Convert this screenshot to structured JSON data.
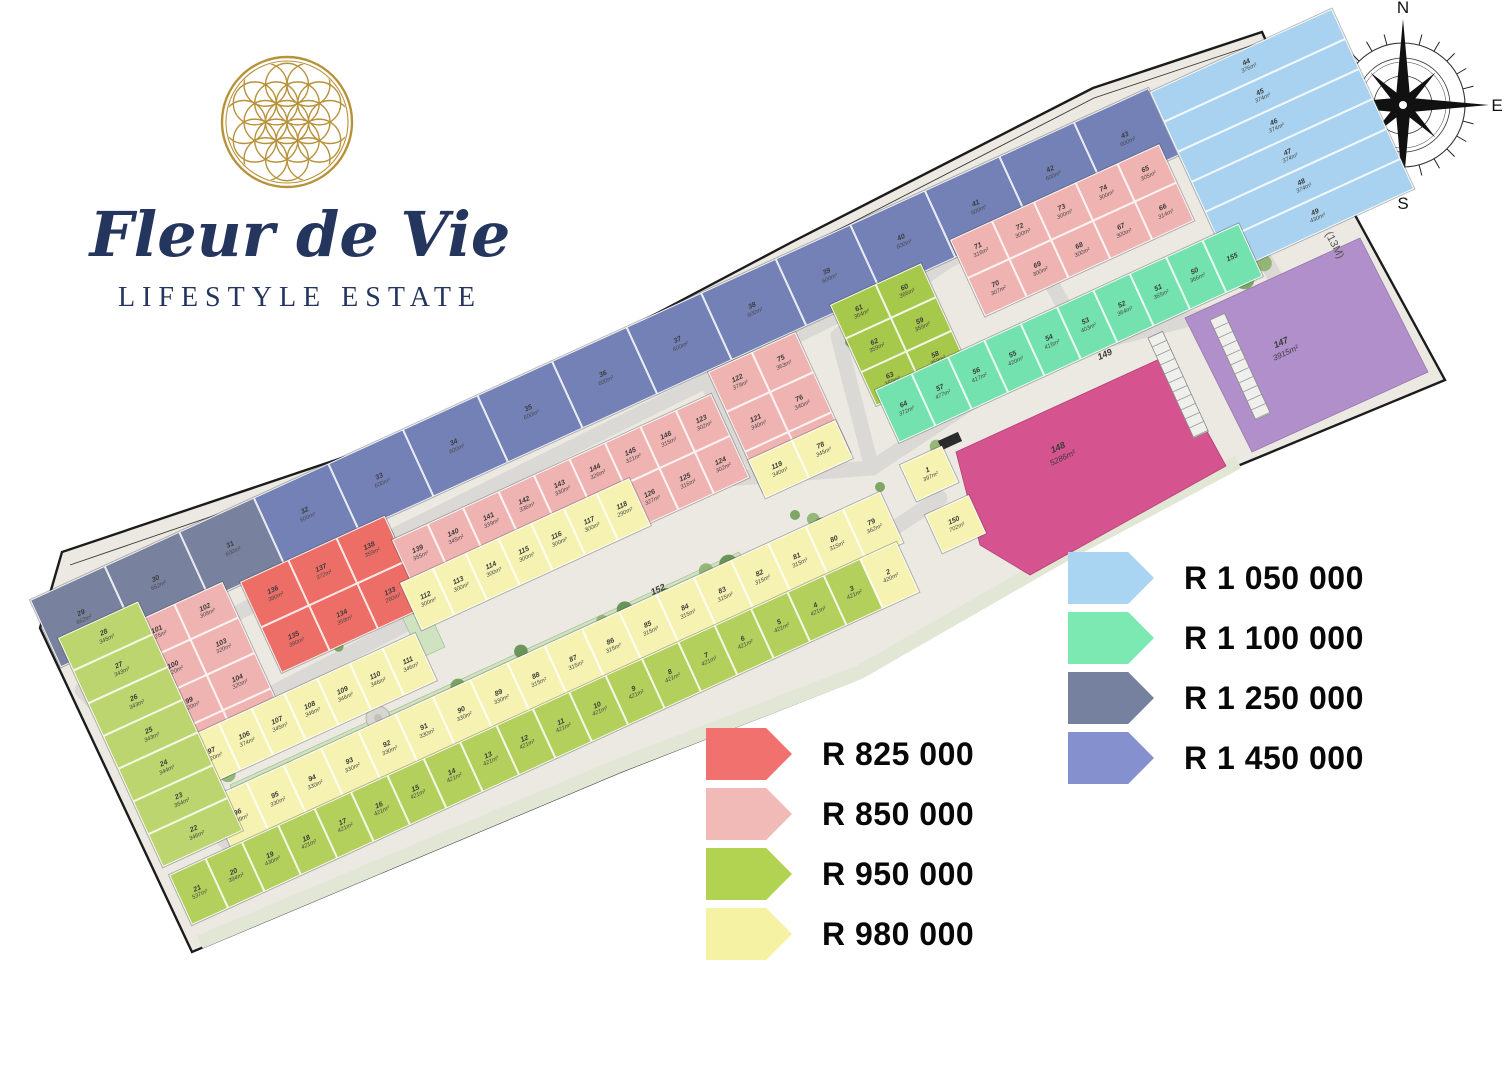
{
  "brand": {
    "name": "Fleur de Vie",
    "tagline": "LIFESTYLE ESTATE"
  },
  "compass": {
    "n": "N",
    "e": "E",
    "s": "S",
    "w": "W"
  },
  "streets": {
    "aimlee": "AIMLEE LANE",
    "gustav": "GUSTAV CRESCENT",
    "gate": "GATE HOUSE",
    "public": "PUBLIC ROAD (13M)"
  },
  "colors": {
    "slate": "#78829E",
    "periwinkle": "#7381B6",
    "lightblue": "#A8D2EF",
    "mint": "#74E2AE",
    "olive": "#A6C84B",
    "green": "#B3D05C",
    "greenlight": "#BCD56E",
    "yellow": "#F6F3B2",
    "pink": "#EFB4B1",
    "red": "#ED6E66",
    "magenta": "#D5538E",
    "purple": "#B18FCB"
  },
  "legend": {
    "left": [
      {
        "label": "R 825 000",
        "color": "#F0716E"
      },
      {
        "label": "R 850 000",
        "color": "#F2BAB6"
      },
      {
        "label": "R 950 000",
        "color": "#B2D252"
      },
      {
        "label": "R 980 000",
        "color": "#F5F2A3"
      }
    ],
    "right": [
      {
        "label": "R 1 050 000",
        "color": "#A9D4F2"
      },
      {
        "label": "R 1 100 000",
        "color": "#7DE9B2"
      },
      {
        "label": "R 1 250 000",
        "color": "#75819E"
      },
      {
        "label": "R 1 450 000",
        "color": "#8590CF"
      }
    ]
  },
  "features": {
    "park_main": {
      "no": "152",
      "area": "6521m²"
    },
    "park_cross": {
      "no": "153"
    },
    "park_east": {
      "no": "151"
    },
    "gate_park": {
      "no": "154"
    },
    "parking": {
      "no": "149"
    },
    "clubhouse": {
      "no": "148",
      "area": "5286m²"
    },
    "estate_lot": {
      "no": "147",
      "area": "3915m²"
    }
  },
  "map": {
    "zones": [
      {
        "id": "blue_row",
        "color": "periwinkle",
        "plots": [
          {
            "n": "29",
            "a": "662m²",
            "c": "slate"
          },
          {
            "n": "30",
            "a": "662m²",
            "c": "slate"
          },
          {
            "n": "31",
            "a": "600m²",
            "c": "slate"
          },
          {
            "n": "32",
            "a": "600m²"
          },
          {
            "n": "33",
            "a": "600m²"
          },
          {
            "n": "34",
            "a": "600m²"
          },
          {
            "n": "35",
            "a": "600m²"
          },
          {
            "n": "36",
            "a": "600m²"
          },
          {
            "n": "37",
            "a": "600m²"
          },
          {
            "n": "38",
            "a": "600m²"
          },
          {
            "n": "39",
            "a": "600m²"
          },
          {
            "n": "40",
            "a": "600m²"
          },
          {
            "n": "41",
            "a": "600m²"
          },
          {
            "n": "42",
            "a": "600m²"
          },
          {
            "n": "43",
            "a": "600m²"
          }
        ]
      },
      {
        "id": "lightblue",
        "color": "lightblue",
        "plots": [
          {
            "n": "44",
            "a": "376m²"
          },
          {
            "n": "45",
            "a": "374m²"
          },
          {
            "n": "46",
            "a": "374m²"
          },
          {
            "n": "47",
            "a": "374m²"
          },
          {
            "n": "48",
            "a": "374m²"
          },
          {
            "n": "49",
            "a": "430m²"
          }
        ]
      },
      {
        "id": "pink_w",
        "color": "pink",
        "plots": [
          {
            "n": "101",
            "a": "325m²"
          },
          {
            "n": "102",
            "a": "308m²"
          },
          {
            "n": "100",
            "a": "320m²"
          },
          {
            "n": "103",
            "a": "320m²"
          },
          {
            "n": "99",
            "a": "320m²"
          },
          {
            "n": "104",
            "a": "320m²"
          },
          {
            "n": "98",
            "a": "320m²"
          },
          {
            "n": "105",
            "a": "322m²"
          }
        ]
      },
      {
        "id": "red",
        "color": "red",
        "plots": [
          {
            "n": "136",
            "a": "380m²"
          },
          {
            "n": "137",
            "a": "372m²"
          },
          {
            "n": "138",
            "a": "359m²"
          },
          {
            "n": "135",
            "a": "380m²"
          },
          {
            "n": "134",
            "a": "358m²"
          },
          {
            "n": "133",
            "a": "260m²"
          }
        ]
      },
      {
        "id": "pink_mid",
        "color": "pink",
        "plots": [
          {
            "n": "139",
            "a": "355m²"
          },
          {
            "n": "140",
            "a": "345m²"
          },
          {
            "n": "141",
            "a": "339m²"
          },
          {
            "n": "142",
            "a": "336m²"
          },
          {
            "n": "143",
            "a": "330m²"
          },
          {
            "n": "144",
            "a": "326m²"
          },
          {
            "n": "145",
            "a": "321m²"
          },
          {
            "n": "146",
            "a": "315m²"
          },
          {
            "n": "123",
            "a": "302m²"
          },
          {
            "n": "132",
            "a": "355m²"
          },
          {
            "n": "131",
            "a": "356m²"
          },
          {
            "n": "130",
            "a": "335m²"
          },
          {
            "n": "129",
            "a": "335m²"
          },
          {
            "n": "128",
            "a": "330m²"
          },
          {
            "n": "127",
            "a": "326m²"
          },
          {
            "n": "126",
            "a": "327m²"
          },
          {
            "n": "125",
            "a": "316m²"
          },
          {
            "n": "124",
            "a": "302m²"
          }
        ]
      },
      {
        "id": "pink_e",
        "color": "pink",
        "plots": [
          {
            "n": "122",
            "a": "379m²"
          },
          {
            "n": "75",
            "a": "363m²"
          },
          {
            "n": "121",
            "a": "340m²"
          },
          {
            "n": "76",
            "a": "340m²"
          },
          {
            "n": "120",
            "a": "340m²"
          },
          {
            "n": "77",
            "a": "340m²"
          }
        ]
      },
      {
        "id": "yellow_e",
        "color": "yellow",
        "plots": [
          {
            "n": "119",
            "a": "340m²"
          },
          {
            "n": "78",
            "a": "345m²"
          }
        ]
      },
      {
        "id": "pink_ne",
        "color": "pink",
        "plots": [
          {
            "n": "71",
            "a": "316m²"
          },
          {
            "n": "72",
            "a": "300m²"
          },
          {
            "n": "73",
            "a": "300m²"
          },
          {
            "n": "74",
            "a": "300m²"
          },
          {
            "n": "65",
            "a": "305m²"
          },
          {
            "n": "70",
            "a": "307m²"
          },
          {
            "n": "69",
            "a": "300m²"
          },
          {
            "n": "68",
            "a": "300m²"
          },
          {
            "n": "67",
            "a": "300m²"
          },
          {
            "n": "66",
            "a": "314m²"
          }
        ]
      },
      {
        "id": "olive",
        "color": "olive",
        "plots": [
          {
            "n": "61",
            "a": "364m²"
          },
          {
            "n": "60",
            "a": "366m²"
          },
          {
            "n": "62",
            "a": "359m²"
          },
          {
            "n": "59",
            "a": "359m²"
          },
          {
            "n": "63",
            "a": "359m²"
          },
          {
            "n": "58",
            "a": "359m²"
          }
        ]
      },
      {
        "id": "teal",
        "color": "mint",
        "plots": [
          {
            "n": "64",
            "a": "372m²"
          },
          {
            "n": "57",
            "a": "477m²"
          },
          {
            "n": "56",
            "a": "417m²"
          },
          {
            "n": "55",
            "a": "420m²"
          },
          {
            "n": "54",
            "a": "415m²"
          },
          {
            "n": "53",
            "a": "403m²"
          },
          {
            "n": "52",
            "a": "364m²"
          },
          {
            "n": "51",
            "a": "365m²"
          },
          {
            "n": "50",
            "a": "366m²"
          },
          {
            "n": "155",
            "a": ""
          }
        ]
      },
      {
        "id": "yellow_1a",
        "color": "yellow",
        "plots": [
          {
            "n": "97",
            "a": "320m²"
          },
          {
            "n": "106",
            "a": "374m²"
          },
          {
            "n": "107",
            "a": "345m²"
          },
          {
            "n": "108",
            "a": "346m²"
          },
          {
            "n": "109",
            "a": "346m²"
          },
          {
            "n": "110",
            "a": "346m²"
          },
          {
            "n": "111",
            "a": "346m²"
          }
        ]
      },
      {
        "id": "yellow_1b",
        "color": "yellow",
        "plots": [
          {
            "n": "112",
            "a": "300m²"
          },
          {
            "n": "113",
            "a": "300m²"
          },
          {
            "n": "114",
            "a": "300m²"
          },
          {
            "n": "115",
            "a": "300m²"
          },
          {
            "n": "116",
            "a": "300m²"
          },
          {
            "n": "117",
            "a": "300m²"
          },
          {
            "n": "118",
            "a": "290m²"
          }
        ]
      },
      {
        "id": "yellow_2",
        "color": "yellow",
        "plots": [
          {
            "n": "96",
            "a": "339m²"
          },
          {
            "n": "95",
            "a": "330m²"
          },
          {
            "n": "94",
            "a": "330m²"
          },
          {
            "n": "93",
            "a": "330m²"
          },
          {
            "n": "92",
            "a": "330m²"
          },
          {
            "n": "91",
            "a": "330m²"
          },
          {
            "n": "90",
            "a": "330m²"
          },
          {
            "n": "89",
            "a": "330m²"
          },
          {
            "n": "88",
            "a": "315m²"
          },
          {
            "n": "87",
            "a": "315m²"
          },
          {
            "n": "86",
            "a": "315m²"
          },
          {
            "n": "85",
            "a": "315m²"
          },
          {
            "n": "84",
            "a": "315m²"
          },
          {
            "n": "83",
            "a": "315m²"
          },
          {
            "n": "82",
            "a": "315m²"
          },
          {
            "n": "81",
            "a": "315m²"
          },
          {
            "n": "80",
            "a": "315m²"
          },
          {
            "n": "79",
            "a": "362m²"
          }
        ]
      },
      {
        "id": "green_row",
        "color": "green",
        "plots": [
          {
            "n": "21",
            "a": "537m²"
          },
          {
            "n": "20",
            "a": "394m²"
          },
          {
            "n": "19",
            "a": "430m²"
          },
          {
            "n": "18",
            "a": "421m²"
          },
          {
            "n": "17",
            "a": "421m²"
          },
          {
            "n": "16",
            "a": "421m²"
          },
          {
            "n": "15",
            "a": "421m²"
          },
          {
            "n": "14",
            "a": "421m²"
          },
          {
            "n": "13",
            "a": "421m²"
          },
          {
            "n": "12",
            "a": "421m²"
          },
          {
            "n": "11",
            "a": "421m²"
          },
          {
            "n": "10",
            "a": "421m²"
          },
          {
            "n": "9",
            "a": "421m²"
          },
          {
            "n": "8",
            "a": "421m²"
          },
          {
            "n": "7",
            "a": "421m²"
          },
          {
            "n": "6",
            "a": "421m²"
          },
          {
            "n": "5",
            "a": "421m²"
          },
          {
            "n": "4",
            "a": "421m²"
          },
          {
            "n": "3",
            "a": "421m²"
          },
          {
            "n": "2",
            "a": "420m²",
            "c": "yellow"
          }
        ]
      },
      {
        "id": "green_w",
        "color": "greenlight",
        "plots": [
          {
            "n": "28",
            "a": "345m²"
          },
          {
            "n": "27",
            "a": "343m²"
          },
          {
            "n": "26",
            "a": "343m²"
          },
          {
            "n": "25",
            "a": "343m²"
          },
          {
            "n": "24",
            "a": "344m²"
          },
          {
            "n": "23",
            "a": "354m²"
          },
          {
            "n": "22",
            "a": "346m²"
          }
        ]
      },
      {
        "id": "lot1",
        "color": "yellow",
        "plots": [
          {
            "n": "1",
            "a": "397m²"
          }
        ]
      },
      {
        "id": "lot150",
        "color": "yellow",
        "plots": [
          {
            "n": "150",
            "a": "702m²"
          }
        ]
      }
    ]
  }
}
